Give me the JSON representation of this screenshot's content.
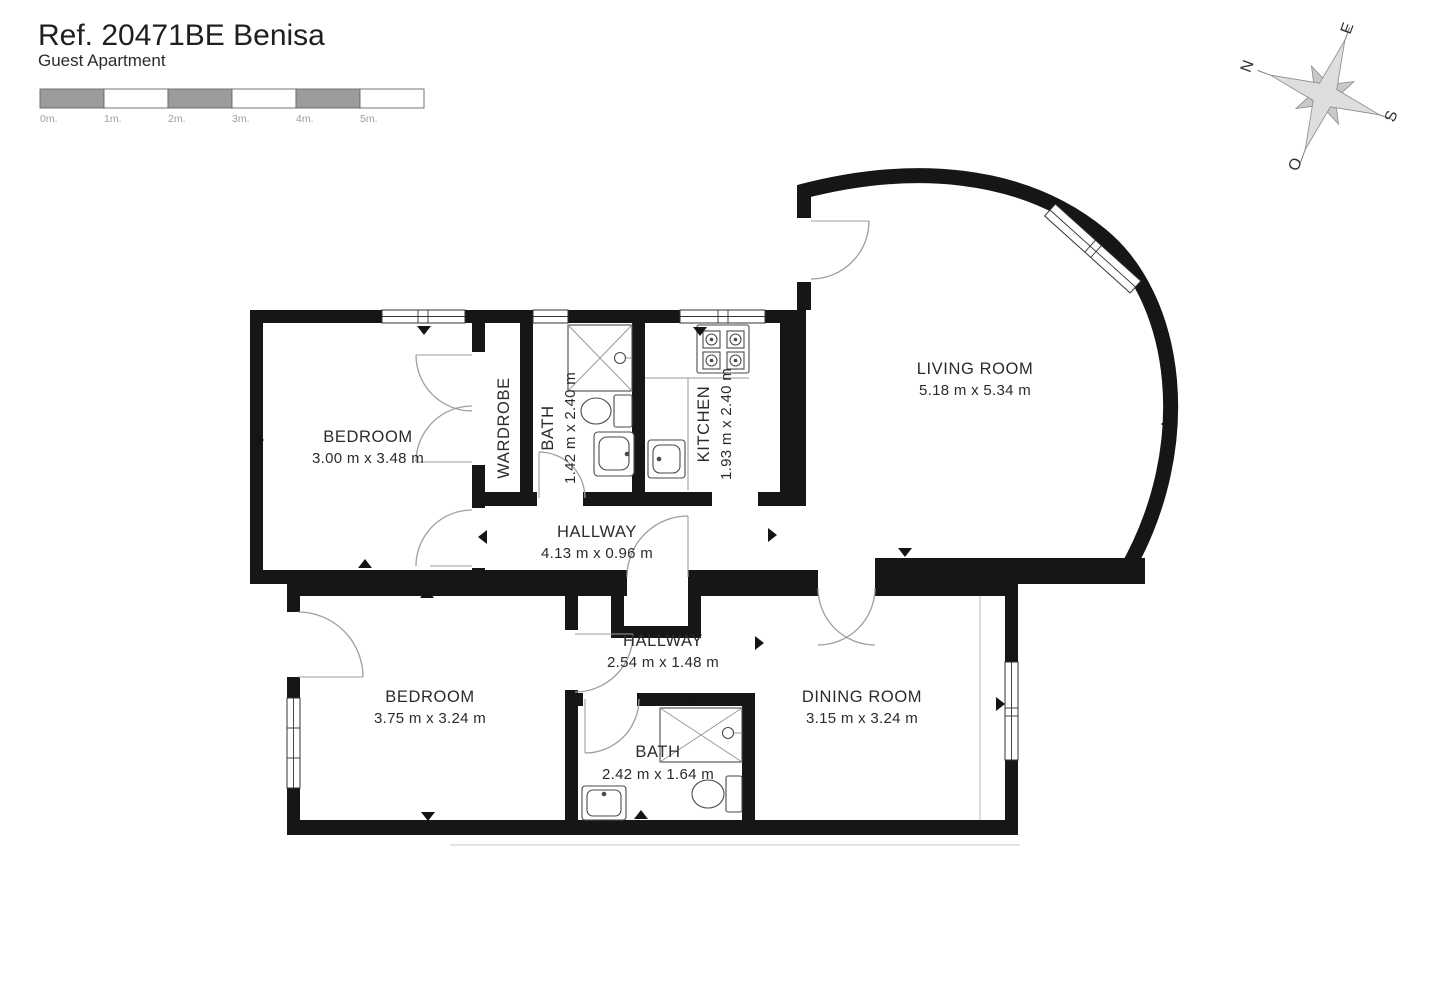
{
  "header": {
    "reference": "Ref. 20471BE Benisa",
    "subtitle": "Guest Apartment"
  },
  "scale_bar": {
    "labels": [
      "0m.",
      "1m.",
      "2m.",
      "3m.",
      "4m.",
      "5m."
    ],
    "segment_gray": "#9b9b9b",
    "segment_white": "#ffffff"
  },
  "compass": {
    "north": "N",
    "east": "E",
    "south": "S",
    "west": "O"
  },
  "floor_plan": {
    "rooms": [
      {
        "id": "bedroom-1",
        "name": "BEDROOM",
        "dimensions": "3.00 m x 3.48 m"
      },
      {
        "id": "wardrobe",
        "name": "WARDROBE",
        "dimensions": ""
      },
      {
        "id": "bath-1",
        "name": "BATH",
        "dimensions": "1.42 m x 2.40 m"
      },
      {
        "id": "kitchen",
        "name": "KITCHEN",
        "dimensions": "1.93 m x 2.40 m"
      },
      {
        "id": "living-room",
        "name": "LIVING ROOM",
        "dimensions": "5.18 m x 5.34 m"
      },
      {
        "id": "hallway-1",
        "name": "HALLWAY",
        "dimensions": "4.13 m x 0.96 m"
      },
      {
        "id": "hallway-2",
        "name": "HALLWAY",
        "dimensions": "2.54 m x 1.48 m"
      },
      {
        "id": "bedroom-2",
        "name": "BEDROOM",
        "dimensions": "3.75 m x 3.24 m"
      },
      {
        "id": "dining-room",
        "name": "DINING ROOM",
        "dimensions": "3.15 m x 3.24 m"
      },
      {
        "id": "bath-2",
        "name": "BATH",
        "dimensions": "2.42 m x 1.64 m"
      }
    ],
    "fixtures": [
      "stove",
      "kitchen-sink",
      "shower",
      "toilet",
      "sink",
      "shower",
      "toilet",
      "sink"
    ]
  },
  "colors": {
    "wall": "#161616",
    "door_arc": "#9e9e9e",
    "text": "#2b2b2b",
    "compass_fill": "#d6d6d6",
    "scale_gray": "#9b9b9b"
  }
}
